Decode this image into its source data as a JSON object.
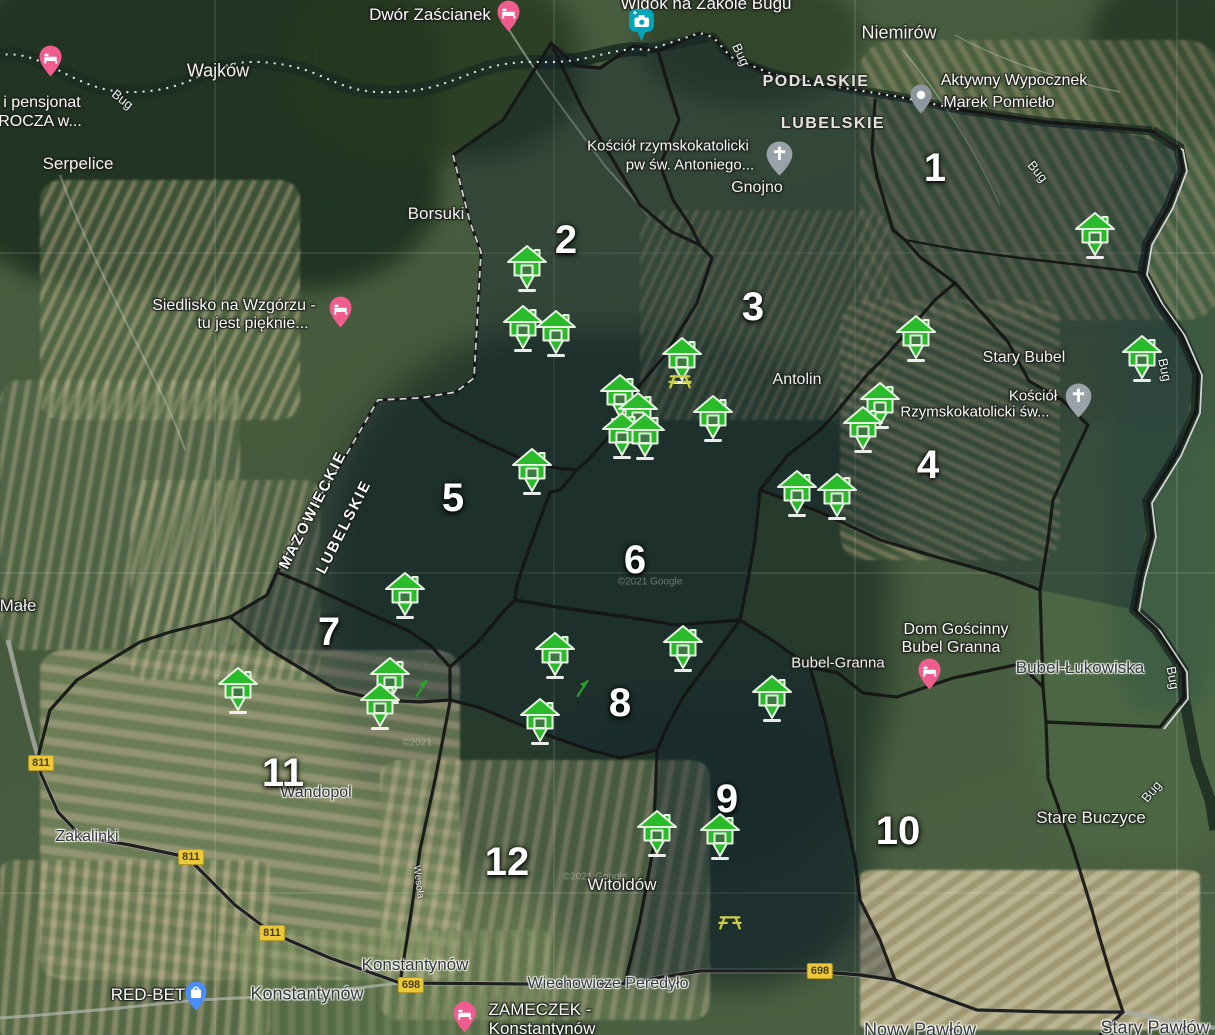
{
  "map_title": "Zone map – Bug river area (satellite)",
  "colors": {
    "house_green": "#2abb2a",
    "boundary_black": "#151515",
    "shield_yellow": "#edc939",
    "lodging_pink": "#ef5d8f",
    "camera_teal": "#00a5b8",
    "church_gray": "#97a0a6",
    "shopping_blue": "#4b8cf5",
    "picnic_yellow": "#cfcf45"
  },
  "zones": [
    {
      "label": "1",
      "x": 935,
      "y": 168
    },
    {
      "label": "2",
      "x": 566,
      "y": 240
    },
    {
      "label": "3",
      "x": 753,
      "y": 307
    },
    {
      "label": "4",
      "x": 928,
      "y": 465
    },
    {
      "label": "5",
      "x": 453,
      "y": 498
    },
    {
      "label": "6",
      "x": 635,
      "y": 560
    },
    {
      "label": "7",
      "x": 329,
      "y": 632
    },
    {
      "label": "8",
      "x": 620,
      "y": 703
    },
    {
      "label": "9",
      "x": 727,
      "y": 799
    },
    {
      "label": "10",
      "x": 898,
      "y": 831
    },
    {
      "label": "11",
      "x": 283,
      "y": 773
    },
    {
      "label": "12",
      "x": 507,
      "y": 862
    }
  ],
  "towns": [
    {
      "label": "Wajków",
      "x": 218,
      "y": 71,
      "size": 18,
      "tone": "light"
    },
    {
      "label": "Serpelice",
      "x": 78,
      "y": 164,
      "size": 17,
      "tone": "light"
    },
    {
      "label": "Borsuki",
      "x": 436,
      "y": 214,
      "size": 17,
      "tone": "light"
    },
    {
      "label": "Niemirów",
      "x": 899,
      "y": 33,
      "size": 18,
      "tone": "light"
    },
    {
      "label": "Gnojno",
      "x": 757,
      "y": 188,
      "size": 16,
      "tone": "light"
    },
    {
      "label": "Antolin",
      "x": 797,
      "y": 380,
      "size": 16,
      "tone": "light"
    },
    {
      "label": "Stary Bubel",
      "x": 1024,
      "y": 358,
      "size": 16,
      "tone": "light"
    },
    {
      "label": "Bubel-Granna",
      "x": 838,
      "y": 663,
      "size": 15,
      "tone": "light"
    },
    {
      "label": "Bubel-Łukowiska",
      "x": 1080,
      "y": 668,
      "size": 17,
      "tone": "dark"
    },
    {
      "label": "Wandopol",
      "x": 316,
      "y": 793,
      "size": 16,
      "tone": "dark"
    },
    {
      "label": "Zakalinki",
      "x": 87,
      "y": 837,
      "size": 16,
      "tone": "dark"
    },
    {
      "label": "Witoldów",
      "x": 622,
      "y": 885,
      "size": 17,
      "tone": "light"
    },
    {
      "label": "Konstantynów",
      "x": 415,
      "y": 965,
      "size": 17,
      "tone": "dark"
    },
    {
      "label": "Konstantynów",
      "x": 307,
      "y": 994,
      "size": 18,
      "tone": "dark"
    },
    {
      "label": "Stare Buczyce",
      "x": 1091,
      "y": 818,
      "size": 17,
      "tone": "light"
    },
    {
      "label": "Nowy Pawłów",
      "x": 920,
      "y": 1030,
      "size": 18,
      "tone": "dark"
    },
    {
      "label": "Stary Pawłów",
      "x": 1155,
      "y": 1028,
      "size": 18,
      "tone": "dark"
    },
    {
      "label": "Małe",
      "x": 18,
      "y": 606,
      "size": 17,
      "tone": "light"
    },
    {
      "label": "Wiechowicze Peredyło",
      "x": 608,
      "y": 984,
      "size": 16,
      "tone": "dark"
    }
  ],
  "provinces": [
    {
      "label": "PODLASKIE",
      "x": 816,
      "y": 82
    },
    {
      "label": "LUBELSKIE",
      "x": 833,
      "y": 124
    }
  ],
  "border_labels": [
    {
      "label": "MAZOWIECKIE",
      "x": 313,
      "y": 510,
      "rot": -63
    },
    {
      "label": "LUBELSKIE",
      "x": 344,
      "y": 527,
      "rot": -63
    }
  ],
  "river_labels": [
    {
      "label": "Bug",
      "x": 122,
      "y": 100,
      "rot": 38
    },
    {
      "label": "Bug",
      "x": 740,
      "y": 55,
      "rot": 65
    },
    {
      "label": "Bug",
      "x": 1037,
      "y": 172,
      "rot": 50
    },
    {
      "label": "Bug",
      "x": 1164,
      "y": 370,
      "rot": 78
    },
    {
      "label": "Bug",
      "x": 1172,
      "y": 678,
      "rot": 80
    },
    {
      "label": "Bug",
      "x": 1152,
      "y": 792,
      "rot": -50
    }
  ],
  "street_labels": [
    {
      "label": "Wesoła",
      "x": 418,
      "y": 882,
      "rot": 83
    }
  ],
  "road_shields": [
    {
      "label": "811",
      "x": 41,
      "y": 763
    },
    {
      "label": "811",
      "x": 191,
      "y": 857
    },
    {
      "label": "811",
      "x": 272,
      "y": 933
    },
    {
      "label": "698",
      "x": 411,
      "y": 985
    },
    {
      "label": "698",
      "x": 820,
      "y": 971
    }
  ],
  "pois": [
    {
      "kind": "lodging",
      "pin": [
        50,
        61
      ],
      "lines": [
        {
          "t": "i pensjonat",
          "x": 42,
          "y": 103,
          "size": 16
        },
        {
          "t": "ROCZA w...",
          "x": 40,
          "y": 122,
          "size": 16
        }
      ]
    },
    {
      "kind": "lodging",
      "pin": [
        508,
        16
      ],
      "lines": [
        {
          "t": "Dwór Zaścianek",
          "x": 430,
          "y": 15,
          "size": 17
        }
      ]
    },
    {
      "kind": "camera",
      "pin": [
        641,
        26
      ],
      "lines": [
        {
          "t": "Widok na Zakole Bugu",
          "x": 706,
          "y": 4,
          "size": 17
        }
      ]
    },
    {
      "kind": "generic",
      "pin": [
        921,
        99
      ],
      "lines": [
        {
          "t": "Aktywny Wypocznek",
          "x": 1014,
          "y": 81,
          "size": 16
        },
        {
          "t": "Marek Pomietło",
          "x": 999,
          "y": 103,
          "size": 16
        }
      ]
    },
    {
      "kind": "church",
      "pin": [
        779,
        158
      ],
      "lines": [
        {
          "t": "Kościół rzymskokatolicki",
          "x": 668,
          "y": 146,
          "size": 15
        },
        {
          "t": "pw św. Antoniego...",
          "x": 690,
          "y": 165,
          "size": 15
        }
      ]
    },
    {
      "kind": "church",
      "pin": [
        1078,
        400
      ],
      "lines": [
        {
          "t": "Kościół",
          "x": 1033,
          "y": 396,
          "size": 15
        },
        {
          "t": "Rzymskokatolicki św...",
          "x": 975,
          "y": 412,
          "size": 15
        }
      ]
    },
    {
      "kind": "lodging",
      "pin": [
        340,
        312
      ],
      "lines": [
        {
          "t": "Siedlisko na Wzgórzu -",
          "x": 234,
          "y": 306,
          "size": 16
        },
        {
          "t": "tu jest pięknie...",
          "x": 253,
          "y": 324,
          "size": 16
        }
      ]
    },
    {
      "kind": "lodging",
      "pin": [
        929,
        674
      ],
      "lines": [
        {
          "t": "Dom Gościnny",
          "x": 956,
          "y": 630,
          "size": 16
        },
        {
          "t": "Bubel Granna",
          "x": 951,
          "y": 648,
          "size": 16
        }
      ]
    },
    {
      "kind": "shopping",
      "pin": [
        196,
        996
      ],
      "lines": [
        {
          "t": "RED-BET",
          "x": 148,
          "y": 995,
          "size": 17
        }
      ]
    },
    {
      "kind": "lodging",
      "pin": [
        464,
        1017
      ],
      "lines": [
        {
          "t": "ZAMECZEK -",
          "x": 540,
          "y": 1010,
          "size": 17
        },
        {
          "t": "Konstantynów",
          "x": 542,
          "y": 1029,
          "size": 17
        }
      ]
    }
  ],
  "houses": [
    [
      527,
      265
    ],
    [
      523,
      325
    ],
    [
      556,
      330
    ],
    [
      682,
      357
    ],
    [
      620,
      394
    ],
    [
      638,
      412
    ],
    [
      622,
      432
    ],
    [
      645,
      433
    ],
    [
      713,
      415
    ],
    [
      1095,
      232
    ],
    [
      1142,
      355
    ],
    [
      916,
      335
    ],
    [
      880,
      402
    ],
    [
      863,
      426
    ],
    [
      797,
      490
    ],
    [
      837,
      493
    ],
    [
      532,
      468
    ],
    [
      405,
      592
    ],
    [
      238,
      687
    ],
    [
      390,
      677
    ],
    [
      380,
      703
    ],
    [
      555,
      652
    ],
    [
      683,
      645
    ],
    [
      772,
      695
    ],
    [
      540,
      718
    ],
    [
      657,
      830
    ],
    [
      720,
      833
    ]
  ],
  "picnic_icons": [
    {
      "x": 680,
      "y": 380
    },
    {
      "x": 730,
      "y": 921
    }
  ],
  "flag_icons": [
    {
      "x": 422,
      "y": 688
    },
    {
      "x": 583,
      "y": 688
    }
  ],
  "watermarks": [
    {
      "t": "©2021 Google",
      "x": 650,
      "y": 582
    },
    {
      "t": "©2021 Google",
      "x": 595,
      "y": 877
    },
    {
      "t": "©2021",
      "x": 417,
      "y": 743
    }
  ]
}
